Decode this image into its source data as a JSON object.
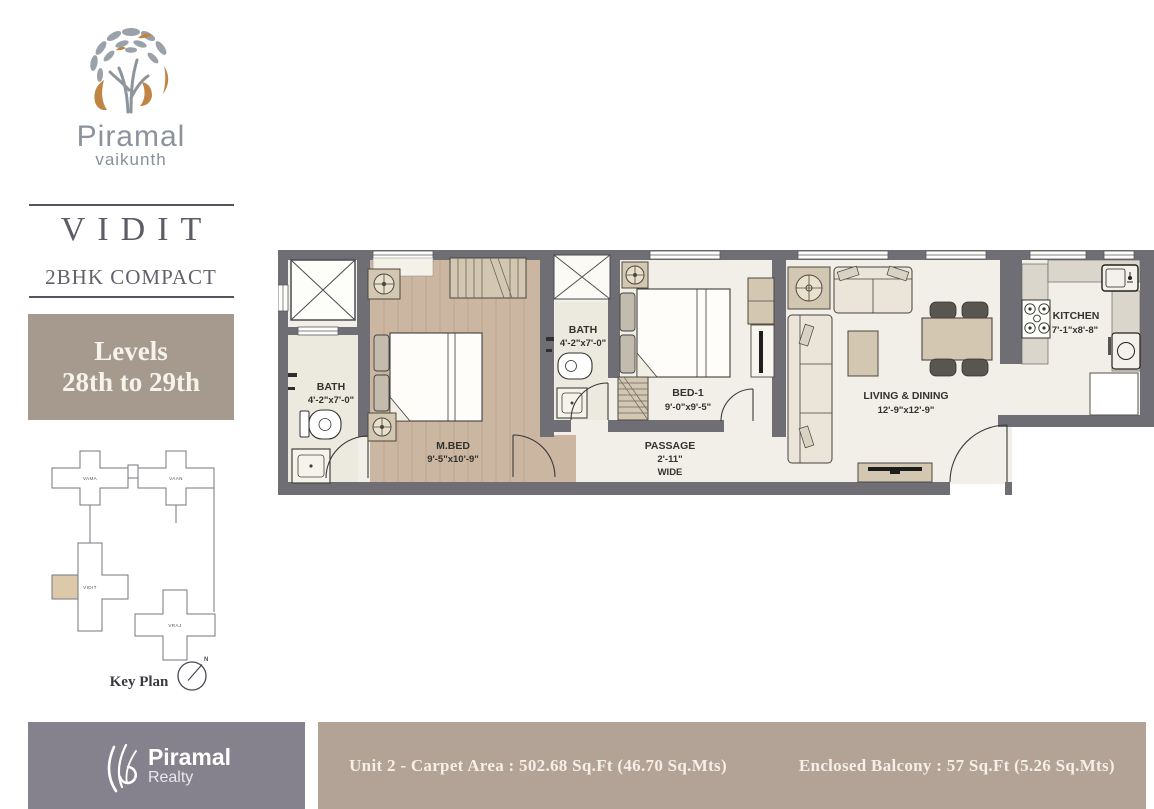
{
  "brand": {
    "name": "Piramal",
    "sub": "vaikunth"
  },
  "unit": {
    "name": "VIDIT",
    "type": "2BHK COMPACT"
  },
  "levels": {
    "line1": "Levels",
    "line2": "28th to 29th"
  },
  "key_plan": {
    "title": "Key Plan",
    "north": "N",
    "towers": {
      "t1": "VAMA",
      "t2": "VAAN",
      "t3": "VIDIT",
      "t4": "VRAJ"
    }
  },
  "rooms": {
    "bath1": {
      "name": "BATH",
      "dim": "4'-2\"x7'-0\""
    },
    "mbed": {
      "name": "M.BED",
      "dim": "9'-5\"x10'-9\""
    },
    "bath2": {
      "name": "BATH",
      "dim": "4'-2\"x7'-0\""
    },
    "bed1": {
      "name": "BED-1",
      "dim": "9'-0\"x9'-5\""
    },
    "passage": {
      "name": "PASSAGE",
      "dim": "2'-11\"",
      "note": "WIDE"
    },
    "living": {
      "name": "LIVING & DINING",
      "dim": "12'-9\"x12'-9\""
    },
    "kitchen": {
      "name": "KITCHEN",
      "dim": "7'-1\"x8'-8\""
    }
  },
  "footer": {
    "logo_name": "Piramal",
    "logo_sub": "Realty",
    "carpet": "Unit 2 - Carpet Area : 502.68 Sq.Ft  (46.70 Sq.Mts)",
    "balcony": "Enclosed Balcony : 57 Sq.Ft  (5.26 Sq.Mts)"
  },
  "colors": {
    "levels_bg": "#a69a8e",
    "footer_gray": "#85818d",
    "footer_taupe": "#b3a296",
    "wall": "#6f6e74",
    "wood_floor": "#cbb6a1",
    "floor_cream": "#f2efe8",
    "furniture_tan": "#d3c7b2",
    "keyplan_highlight": "#dcc9a9",
    "logo_gray": "#9aa1a8",
    "logo_orange": "#c08443"
  }
}
